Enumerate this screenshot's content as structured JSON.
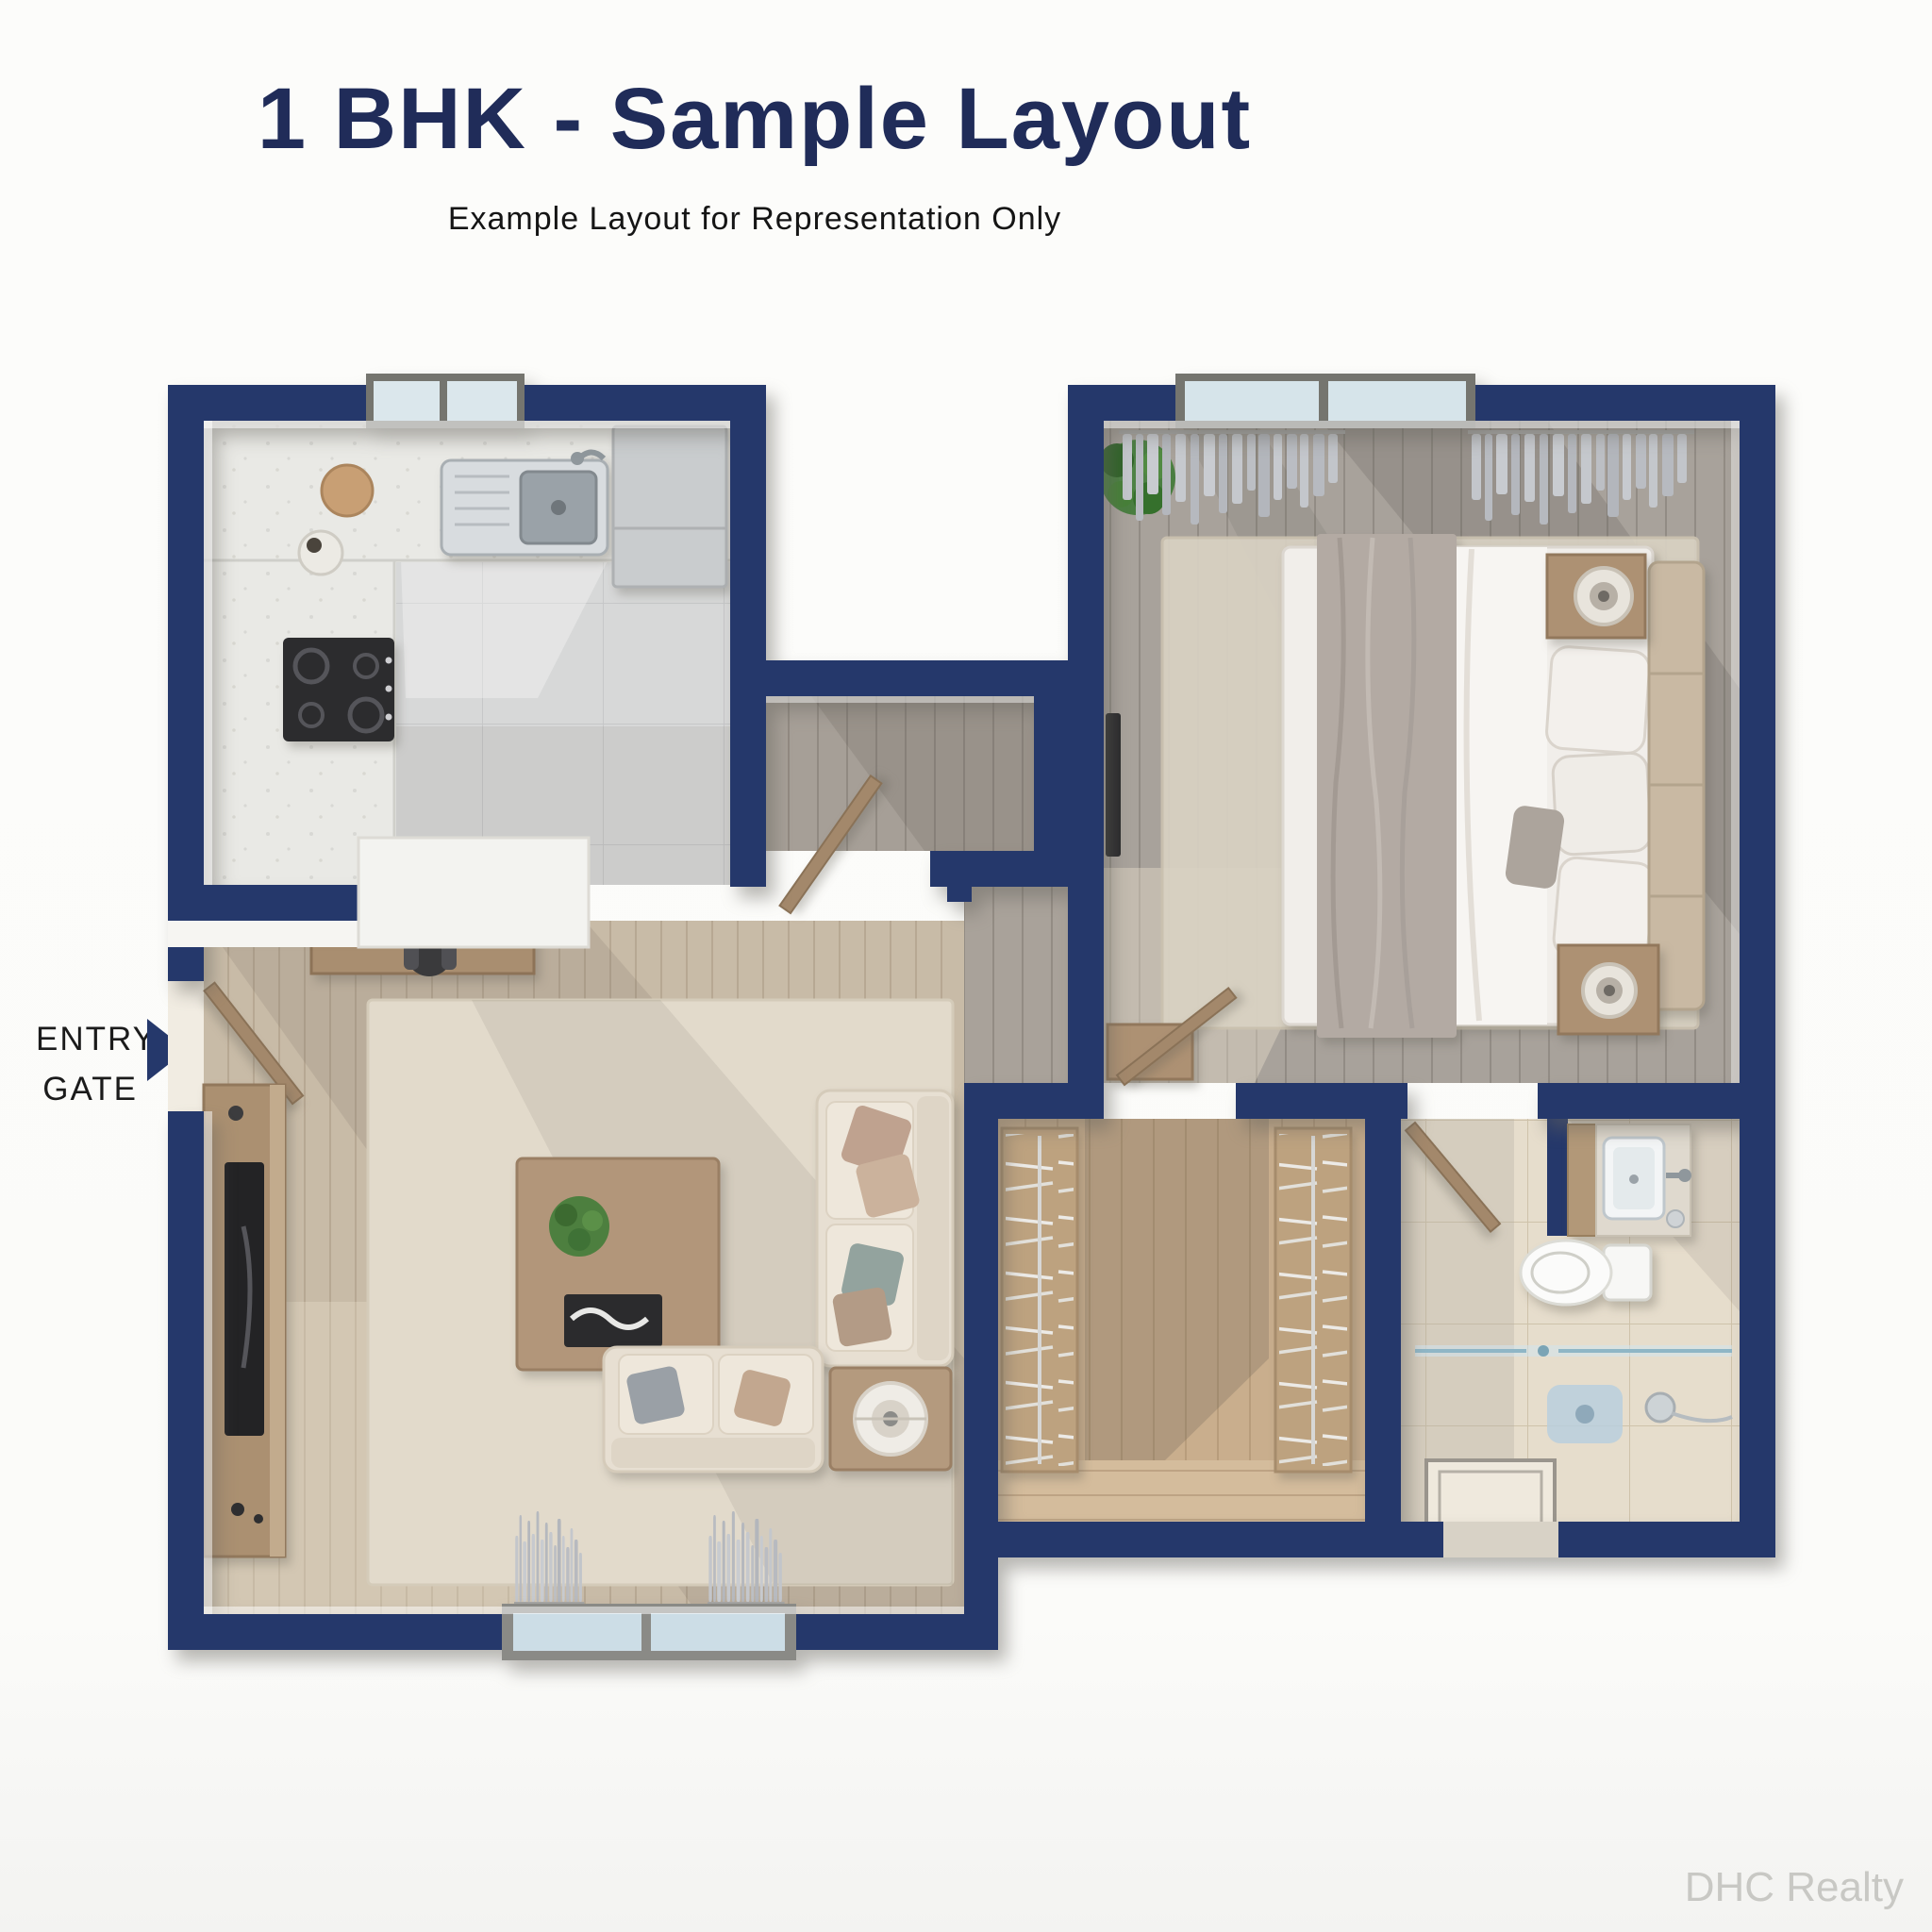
{
  "header": {
    "title": "1 BHK - Sample Layout",
    "subtitle": "Example Layout for Representation Only"
  },
  "entry_gate": {
    "line1": "ENTRY",
    "line2": "GATE"
  },
  "watermark": "DHC Realty",
  "colors": {
    "wall_navy": "#25386b",
    "title_navy": "#202c59",
    "page_bg": "#fbfbf9",
    "kitchen_tile": "#d7d8d8",
    "living_wood": "#cdbfa9",
    "gray_wood": "#a8a29b",
    "wardrobe_wood": "#c9ae8d",
    "bath_tile": "#e6ddcc",
    "rug_beige": "#e2dacb",
    "glass_blue": "#cfe4ee",
    "sofa_beige": "#e7dfd2",
    "furniture_wood": "#ab9071"
  },
  "plan": {
    "rooms": [
      "kitchen",
      "living-room",
      "foyer",
      "bedroom",
      "wardrobe",
      "bathroom"
    ],
    "entry_arrow_direction": "right"
  }
}
